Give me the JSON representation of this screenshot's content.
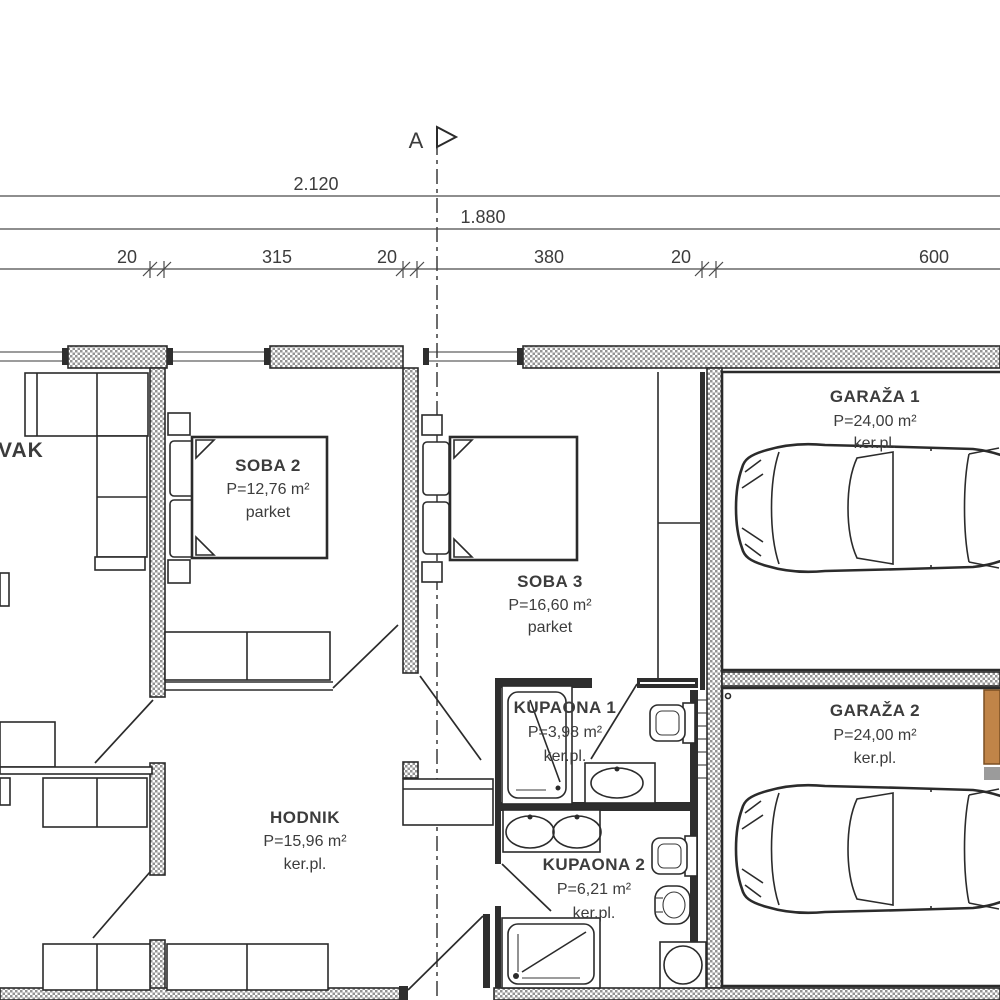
{
  "section_marker": {
    "label": "A"
  },
  "dimension_lines": {
    "total_width": "2.120",
    "inner_width": "1.880",
    "segments": [
      {
        "label": "20"
      },
      {
        "label": "315"
      },
      {
        "label": "20"
      },
      {
        "label": "380"
      },
      {
        "label": "20"
      },
      {
        "label": "600"
      }
    ]
  },
  "rooms": [
    {
      "id": "living-room-partial",
      "name": "VAK",
      "area": "",
      "floor": ""
    },
    {
      "id": "soba-2",
      "name": "SOBA 2",
      "area": "P=12,76 m²",
      "floor": "parket"
    },
    {
      "id": "soba-3",
      "name": "SOBA 3",
      "area": "P=16,60 m²",
      "floor": "parket"
    },
    {
      "id": "hodnik",
      "name": "HODNIK",
      "area": "P=15,96 m²",
      "floor": "ker.pl."
    },
    {
      "id": "kupaona-1",
      "name": "KUPAONA 1",
      "area": "P=3,98 m²",
      "floor": "ker.pl."
    },
    {
      "id": "kupaona-2",
      "name": "KUPAONA 2",
      "area": "P=6,21 m²",
      "floor": "ker.pl."
    },
    {
      "id": "garaza-1",
      "name": "GARAŽA 1",
      "area": "P=24,00 m²",
      "floor": "ker.pl."
    },
    {
      "id": "garaza-2",
      "name": "GARAŽA 2",
      "area": "P=24,00 m²",
      "floor": "ker.pl."
    }
  ],
  "colors": {
    "line": "#2b2b2b",
    "text": "#3c3c3c",
    "wall_hatch_gray": "#949494",
    "cabinet_orange": "#c08448",
    "cabinet_gray": "#9b9b9b",
    "background": "#ffffff"
  }
}
